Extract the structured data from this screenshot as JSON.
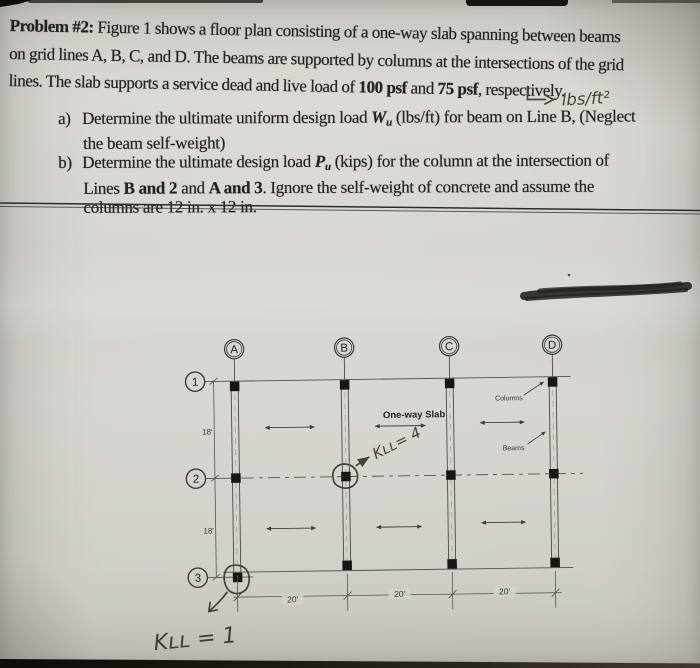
{
  "problem": {
    "title": "Problem #2:",
    "line1": " Figure 1 shows a floor plan consisting of a one-way slab spanning between beams",
    "line2": "on grid lines A, B, C, and D. The beams are supported by columns at the intersections of the grid",
    "line3": {
      "a": "lines. The slab supports a service dead and live load of ",
      "b": "100 psf",
      "c": " and ",
      "d": "75 psf",
      "e": ", respectively."
    },
    "item_a": {
      "marker": "a)",
      "t1": "Determine the ultimate uniform design load ",
      "var": "W",
      "sub": "u",
      "t2": " (lbs/ft) for beam on Line B, (Neglect",
      "t3": "the beam self-weight)"
    },
    "item_b": {
      "marker": "b)",
      "t1": "Determine the ultimate design load ",
      "var": "P",
      "sub": "u",
      "t2": " (kips) for the column at the intersection of",
      "t3a": "Lines ",
      "t3b": "B and 2",
      "t3c": " and ",
      "t3d": "A and 3",
      "t3e": ". Ignore the self-weight of concrete and assume the",
      "t4": "columns are 12 in. x 12 in."
    }
  },
  "handwriting": {
    "unit_note": "lbs/ft²",
    "kll_interior": "Kʟʟ= 4",
    "kll_corner": "Kʟʟ = 1"
  },
  "figure": {
    "grid_columns": [
      "A",
      "B",
      "C",
      "D"
    ],
    "grid_rows": [
      "1",
      "2",
      "3"
    ],
    "dims_vertical": [
      "18'",
      "18'"
    ],
    "dims_horizontal": [
      "20'",
      "20'",
      "20'"
    ],
    "slab_label": "One-way Slab",
    "columns_label": "Columns",
    "beams_label": "Beams"
  },
  "colors": {
    "paper": "#d5d2cc",
    "ink": "#242120",
    "print_line": "#55524e",
    "pencil": "#46413a"
  }
}
